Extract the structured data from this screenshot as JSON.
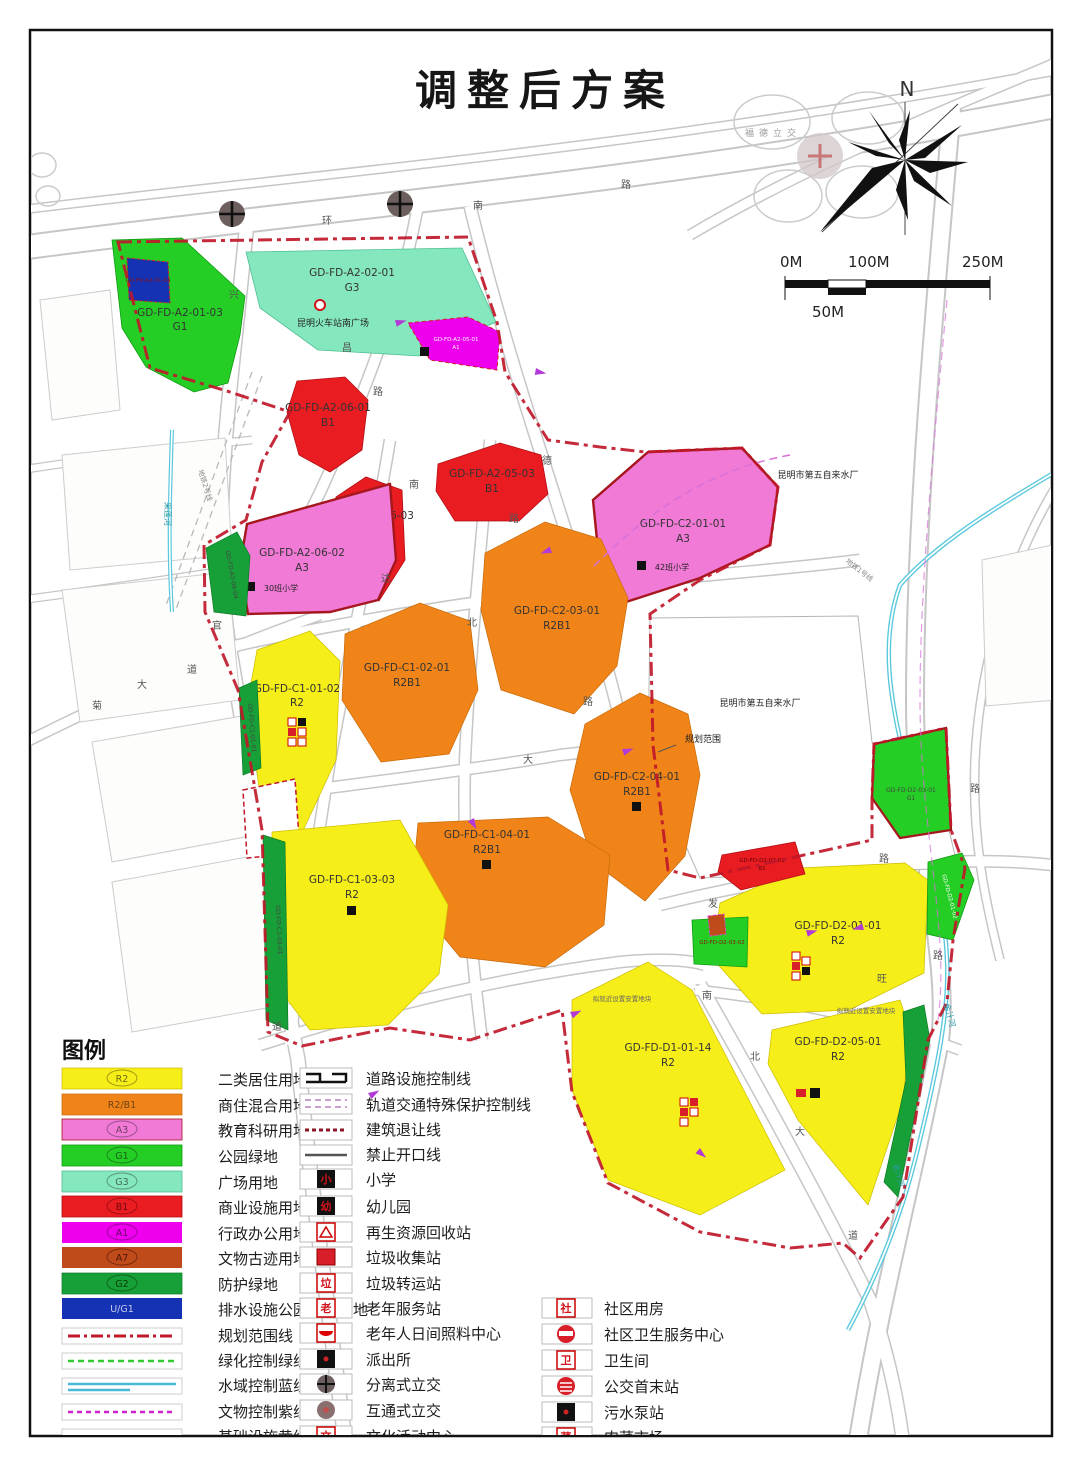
{
  "title": "调整后方案",
  "north": {
    "label": "N"
  },
  "scale_bar": {
    "zero": "0M",
    "hundred": "100M",
    "two_fifty": "250M",
    "fifty": "50M"
  },
  "colors": {
    "residential_r2": "#f6ee18",
    "mixed_r2b1": "#f08418",
    "education_a3": "#f07ad6",
    "park_g1": "#25ce25",
    "square_g3": "#85e7bd",
    "commercial_b1": "#e91c22",
    "admin_a1": "#ee00ee",
    "heritage_a7": "#bf4a1a",
    "protect_g2": "#18a038",
    "drainage_mix": "#1632b4",
    "boundary_red": "#c0182a",
    "river_cyan": "#59c8dc"
  },
  "map": {
    "interchange_label": "福德立交",
    "annotations": [
      {
        "text": "昆明火车站南广场"
      },
      {
        "text": "昆明市第五自来水厂"
      },
      {
        "text": "昆明市第五自来水厂"
      },
      {
        "text": "规划范围"
      },
      {
        "text": "30班小学"
      },
      {
        "text": "42班小学"
      },
      {
        "text": "拟就近设置安置地块"
      },
      {
        "text": "拟就近设置安置地块"
      }
    ],
    "road_labels": [
      {
        "t": "环"
      },
      {
        "t": "南"
      },
      {
        "t": "路"
      },
      {
        "t": "兴"
      },
      {
        "t": "昌"
      },
      {
        "t": "路"
      },
      {
        "t": "南"
      },
      {
        "t": "德"
      },
      {
        "t": "路"
      },
      {
        "t": "达"
      },
      {
        "t": "北"
      },
      {
        "t": "路"
      },
      {
        "t": "大"
      },
      {
        "t": "官"
      },
      {
        "t": "道"
      },
      {
        "t": "大"
      },
      {
        "t": "菊"
      },
      {
        "t": "道"
      },
      {
        "t": "发"
      },
      {
        "t": "路"
      },
      {
        "t": "旺"
      },
      {
        "t": "南"
      },
      {
        "t": "北"
      },
      {
        "t": "大"
      },
      {
        "t": "道"
      },
      {
        "t": "路"
      },
      {
        "t": "路"
      }
    ],
    "rivers": [
      {
        "name": "采莲河"
      },
      {
        "name": "金汁河"
      },
      {
        "name": "金汁河"
      }
    ],
    "metro": [
      {
        "name": "地铁2号线"
      },
      {
        "name": "地铁1号线"
      }
    ],
    "parcels": [
      {
        "code": "GD-FD-A2-01-03",
        "zone": "G1"
      },
      {
        "code": "GD-FD-A2-01-04",
        "zone": ""
      },
      {
        "code": "GD-FD-A2-02-01",
        "zone": "G3"
      },
      {
        "code": "GD-FD-A2-05-01",
        "zone": "A1"
      },
      {
        "code": "GD-FD-A2-06-01",
        "zone": "B1"
      },
      {
        "code": "GD-FD-A2-05-03",
        "zone": "B1"
      },
      {
        "code": "GD-FD-A2-06-03",
        "zone": "B1"
      },
      {
        "code": "GD-FD-A2-06-02",
        "zone": "A3"
      },
      {
        "code": "GD-FD-A2-06-04",
        "zone": "G2"
      },
      {
        "code": "GD-FD-C2-01-01",
        "zone": "A3"
      },
      {
        "code": "GD-FD-C2-03-01",
        "zone": "R2B1"
      },
      {
        "code": "GD-FD-C1-02-01",
        "zone": "R2B1"
      },
      {
        "code": "GD-FD-C1-01-02",
        "zone": "R2"
      },
      {
        "code": "GD-FD-C2-04-01",
        "zone": "R2B1"
      },
      {
        "code": "GD-FD-C1-04-01",
        "zone": "R2B1"
      },
      {
        "code": "GD-FD-C1-03-03",
        "zone": "R2"
      },
      {
        "code": "GD-FD-C1-03-01",
        "zone": "G2"
      },
      {
        "code": "GD-FD-C1-01-01",
        "zone": "G2"
      },
      {
        "code": "GD-FD-D2-01-01",
        "zone": "R2"
      },
      {
        "code": "GD-FD-D2-03-02",
        "zone": "G1"
      },
      {
        "code": "GD-FD-D2-01-02",
        "zone": "G1"
      },
      {
        "code": "GD-FD-D2-02-01",
        "zone": "B1"
      },
      {
        "code": "GD-FD-D2-03-01",
        "zone": "G1"
      },
      {
        "code": "GD-FD-D1-01-14",
        "zone": "R2"
      },
      {
        "code": "GD-FD-D2-05-01",
        "zone": "R2"
      }
    ]
  },
  "legend": {
    "title": "图例",
    "zones": [
      {
        "code": "R2",
        "label": "二类居住用地"
      },
      {
        "code": "R2/B1",
        "label": "商住混合用地"
      },
      {
        "code": "A3",
        "label": "教育科研用地"
      },
      {
        "code": "G1",
        "label": "公园绿地"
      },
      {
        "code": "G3",
        "label": "广场用地"
      },
      {
        "code": "B1",
        "label": "商业设施用地"
      },
      {
        "code": "A1",
        "label": "行政办公用地"
      },
      {
        "code": "A7",
        "label": "文物古迹用地"
      },
      {
        "code": "G2",
        "label": "防护绿地"
      },
      {
        "code": "U/G1",
        "label": "排水设施公园混合用地"
      }
    ],
    "lines": [
      {
        "label": "规划范围线"
      },
      {
        "label": "绿化控制绿线"
      },
      {
        "label": "水域控制蓝线"
      },
      {
        "label": "文物控制紫线"
      },
      {
        "label": "基础设施黄线"
      }
    ],
    "col2": [
      {
        "label": "道路设施控制线"
      },
      {
        "label": "轨道交通特殊保护控制线"
      },
      {
        "label": "建筑退让线"
      },
      {
        "label": "禁止开口线"
      },
      {
        "label": "小学",
        "glyph": "小"
      },
      {
        "label": "幼儿园",
        "glyph": "幼"
      },
      {
        "label": "再生资源回收站"
      },
      {
        "label": "垃圾收集站"
      },
      {
        "label": "垃圾转运站",
        "glyph": "垃"
      },
      {
        "label": "老年服务站",
        "glyph": "老"
      },
      {
        "label": "老年人日间照料中心"
      },
      {
        "label": "派出所"
      },
      {
        "label": "分离式立交"
      },
      {
        "label": "互通式立交"
      },
      {
        "label": "文化活动中心",
        "glyph": "文"
      }
    ],
    "col3": [
      {
        "label": "社区用房",
        "glyph": "社"
      },
      {
        "label": "社区卫生服务中心"
      },
      {
        "label": "卫生间",
        "glyph": "卫"
      },
      {
        "label": "公交首末站"
      },
      {
        "label": "污水泵站"
      },
      {
        "label": "肉菜市场",
        "glyph": "菜"
      }
    ]
  }
}
